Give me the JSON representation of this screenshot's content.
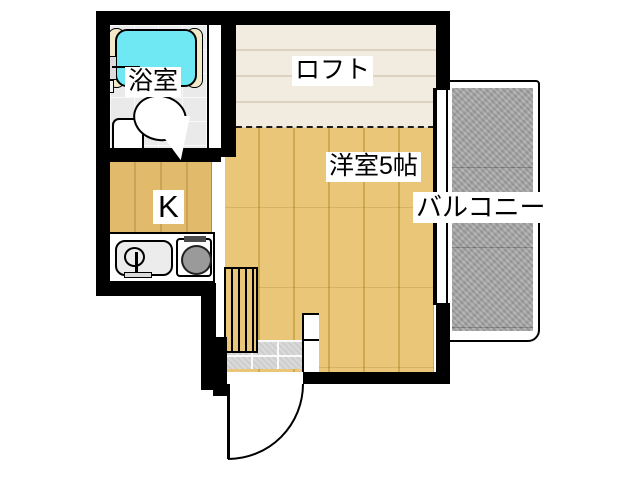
{
  "floorplan": {
    "type": "japanese-apartment-floor-plan",
    "labels": {
      "bathroom": "浴室",
      "loft": "ロフト",
      "main_room": "洋室5帖",
      "kitchen": "K",
      "balcony": "バルコニー"
    },
    "fixtures": [
      "bathtub-icon",
      "bath-faucet-icon",
      "toilet-icon",
      "kitchen-sink-icon",
      "stove-burner-icon",
      "loft-ladder-icon",
      "entrance-tile-floor",
      "entrance-door-swing"
    ]
  },
  "colors": {
    "wall": "#000000",
    "tub": "#6fe8f3",
    "tub_rim": "#f2e9c9",
    "bath_floor": "#eaeaea",
    "loft_floor": "#f1ebe0",
    "loft_line": "#ddd2c0",
    "wood_floor": "#e9c678",
    "wood_line": "#cda94f",
    "kitchen_floor": "#e2ba6b",
    "tile": "#d8d8d8",
    "balcony": "#a9a9a9",
    "burner": "#9a9a9a"
  }
}
